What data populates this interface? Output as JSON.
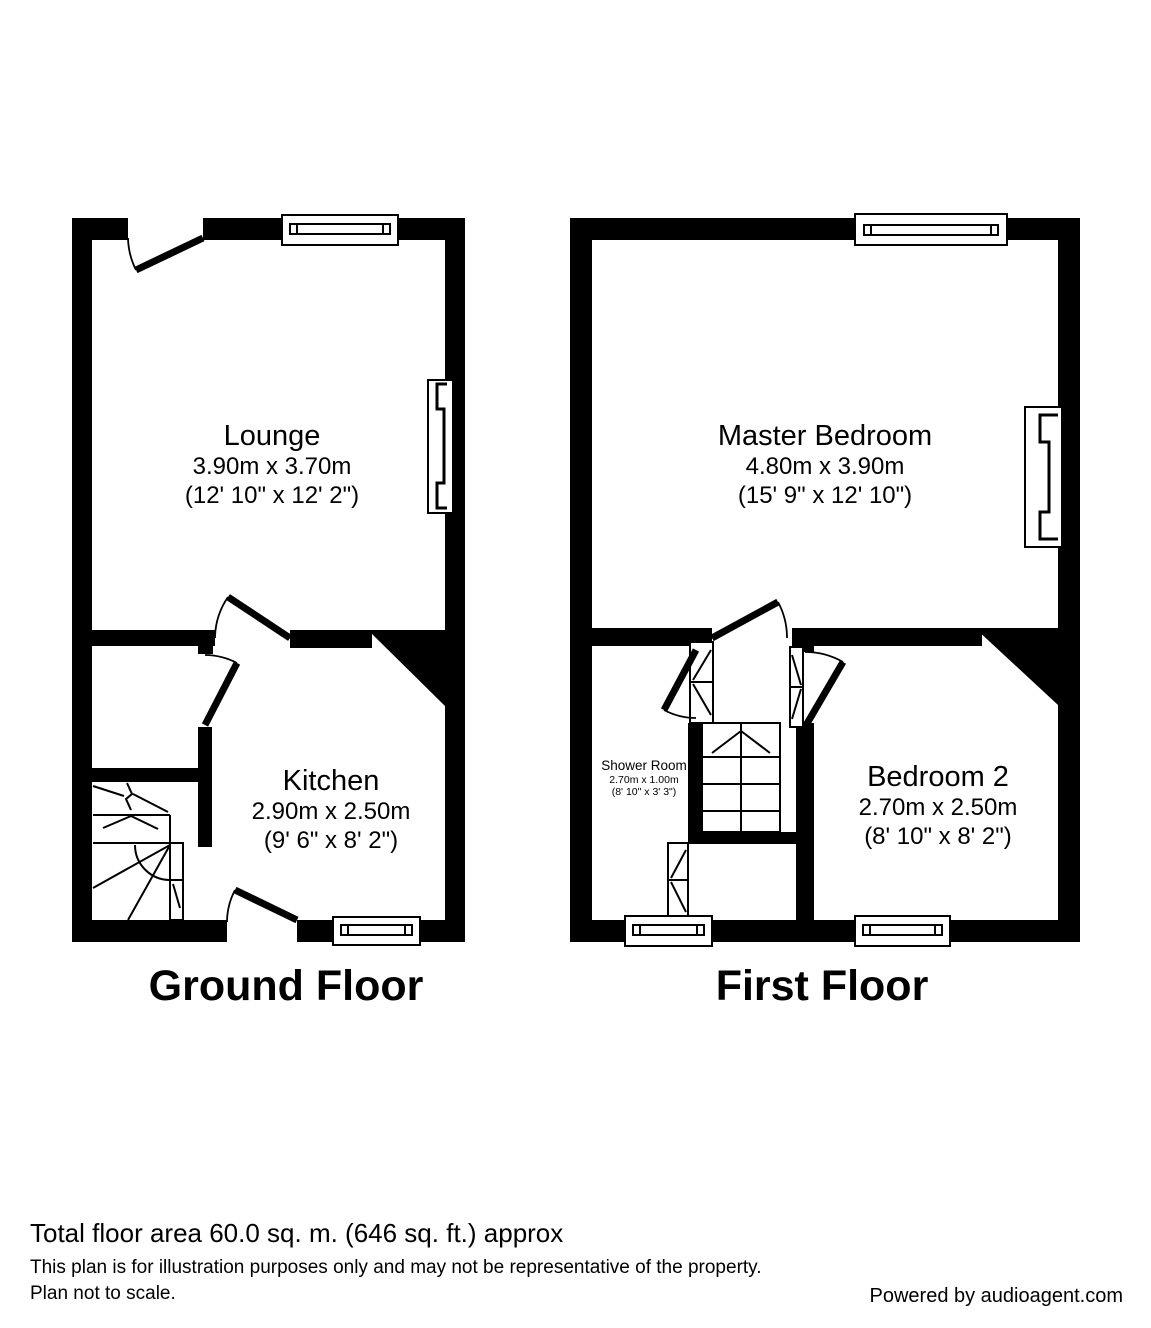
{
  "page": {
    "background": "#ffffff",
    "wall_color": "#000000",
    "text_color": "#000000"
  },
  "floors": [
    {
      "label": "Ground Floor",
      "rooms": [
        {
          "name": "Lounge",
          "metric": "3.90m x 3.70m",
          "imperial": "(12' 10\" x 12' 2\")"
        },
        {
          "name": "Kitchen",
          "metric": "2.90m x 2.50m",
          "imperial": "(9' 6\" x 8' 2\")"
        }
      ]
    },
    {
      "label": "First Floor",
      "rooms": [
        {
          "name": "Master Bedroom",
          "metric": "4.80m x 3.90m",
          "imperial": "(15' 9\" x 12' 10\")"
        },
        {
          "name": "Bedroom 2",
          "metric": "2.70m x 2.50m",
          "imperial": "(8' 10\" x 8' 2\")"
        },
        {
          "name": "Shower Room",
          "metric": "2.70m x 1.00m",
          "imperial": "(8' 10\" x 3' 3\")"
        }
      ]
    }
  ],
  "footer": {
    "total_area": "Total floor area 60.0 sq. m. (646 sq. ft.) approx",
    "disclaimer_line1": "This plan is for illustration purposes only and may not be representative of the property.",
    "disclaimer_line2": "Plan not to scale.",
    "powered_by": "Powered by audioagent.com"
  }
}
